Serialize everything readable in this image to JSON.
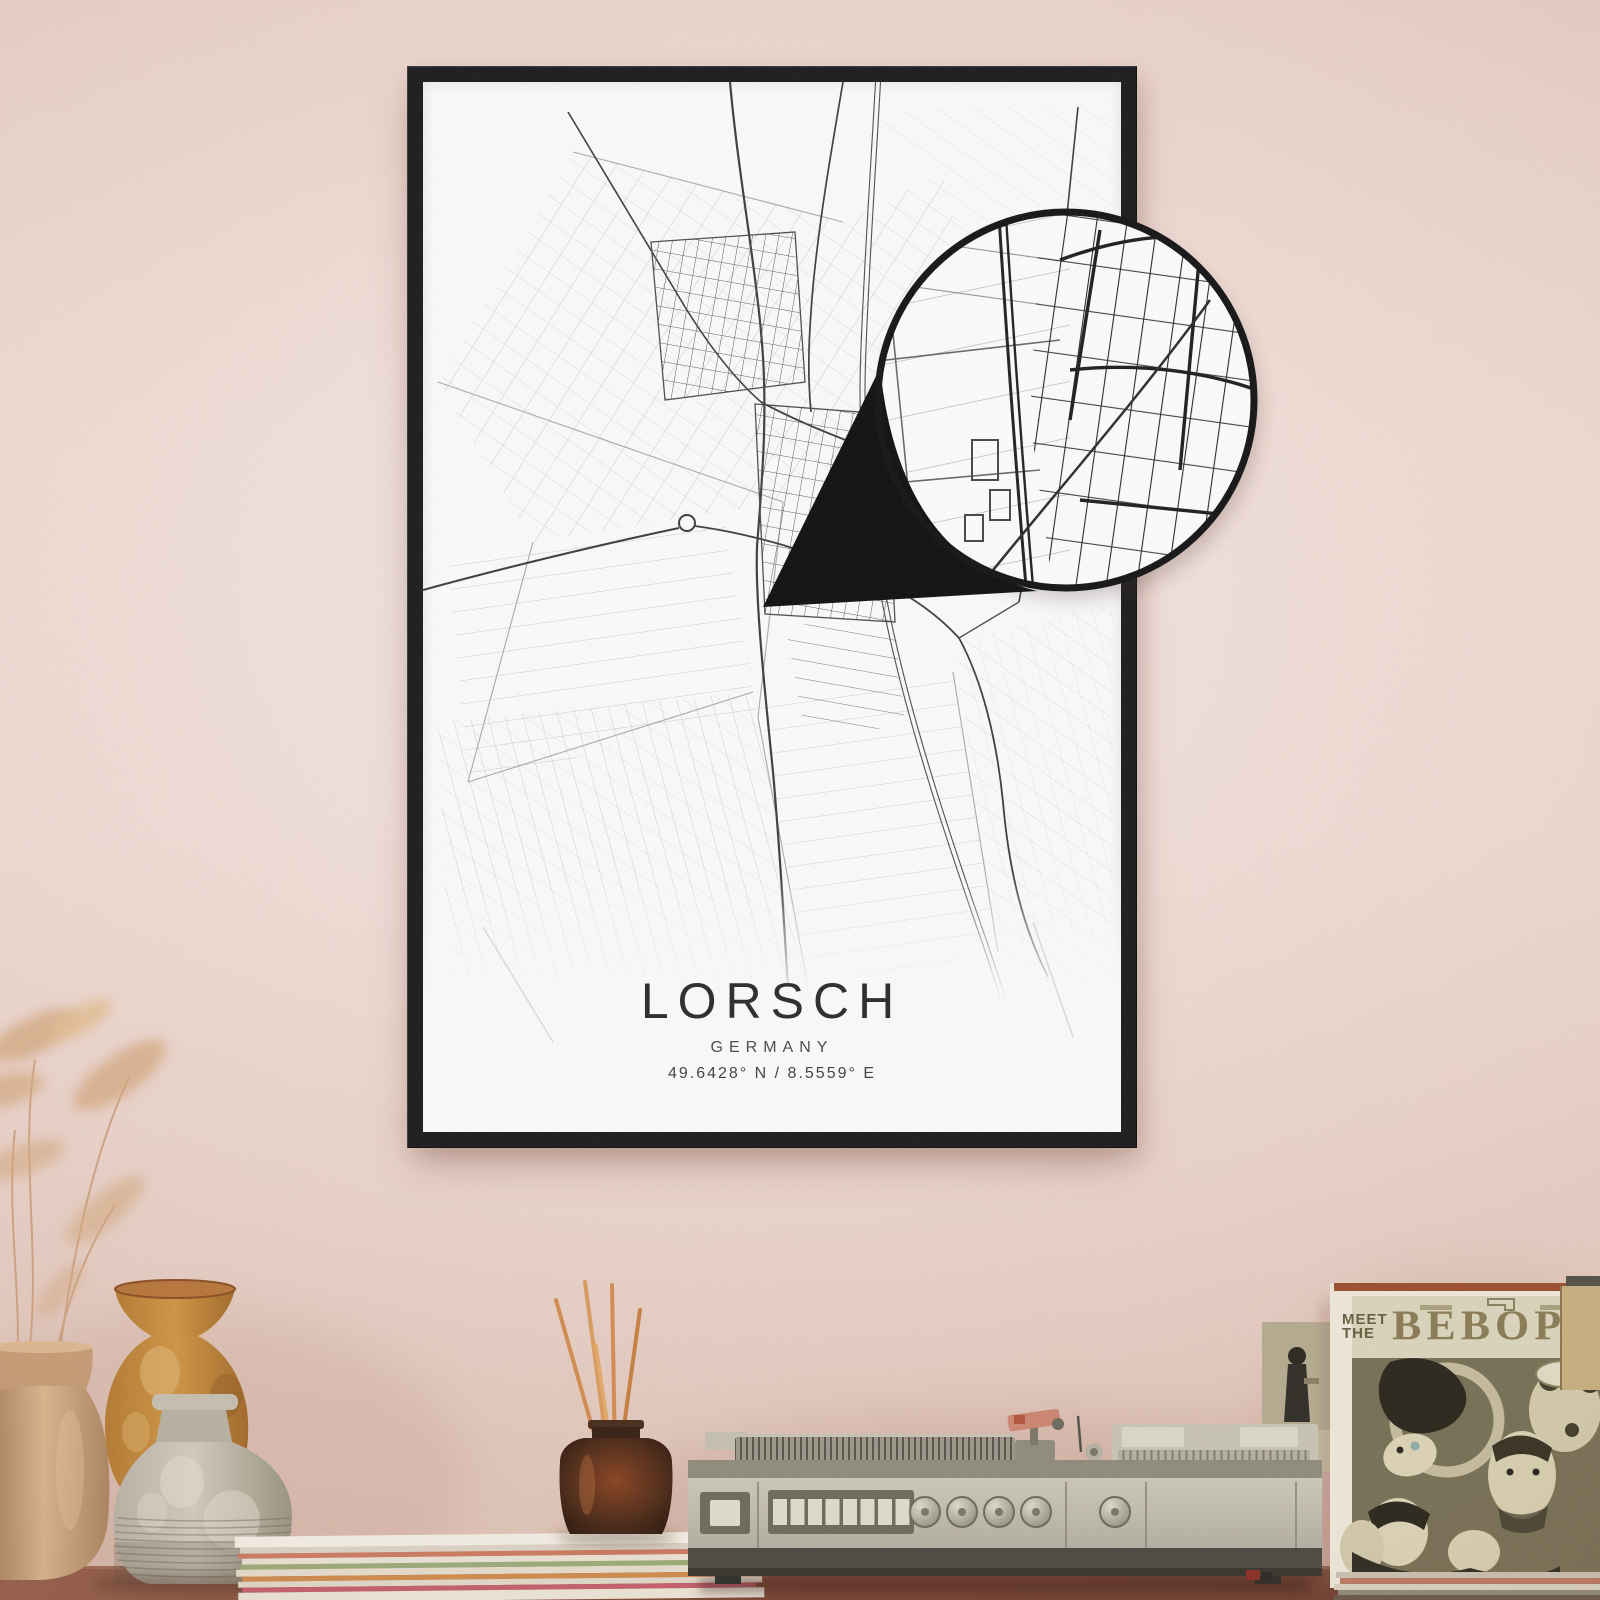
{
  "poster": {
    "title": "LORSCH",
    "country": "GERMANY",
    "coordinates": "49.6428° N / 8.5559° E"
  },
  "record_sleeve": {
    "title_top": "MEET",
    "title_mid": "THE",
    "title_main": "BEBOP"
  },
  "colors": {
    "wall_pink": "#e9d2c9",
    "frame_black": "#17171a",
    "poster_white": "#fcfcfc",
    "map_ink": "#3a3a3e",
    "map_field_gray": "#c9c9c9",
    "sleeve_olive": "#787056",
    "sleeve_band": "#d8d1ba",
    "sleeve_rust_stripe": "#9a4f33",
    "table_brown": "#7c4737",
    "vase_ochre": "#c9913f",
    "diffuser_stick_orange": "#cf8c52"
  }
}
